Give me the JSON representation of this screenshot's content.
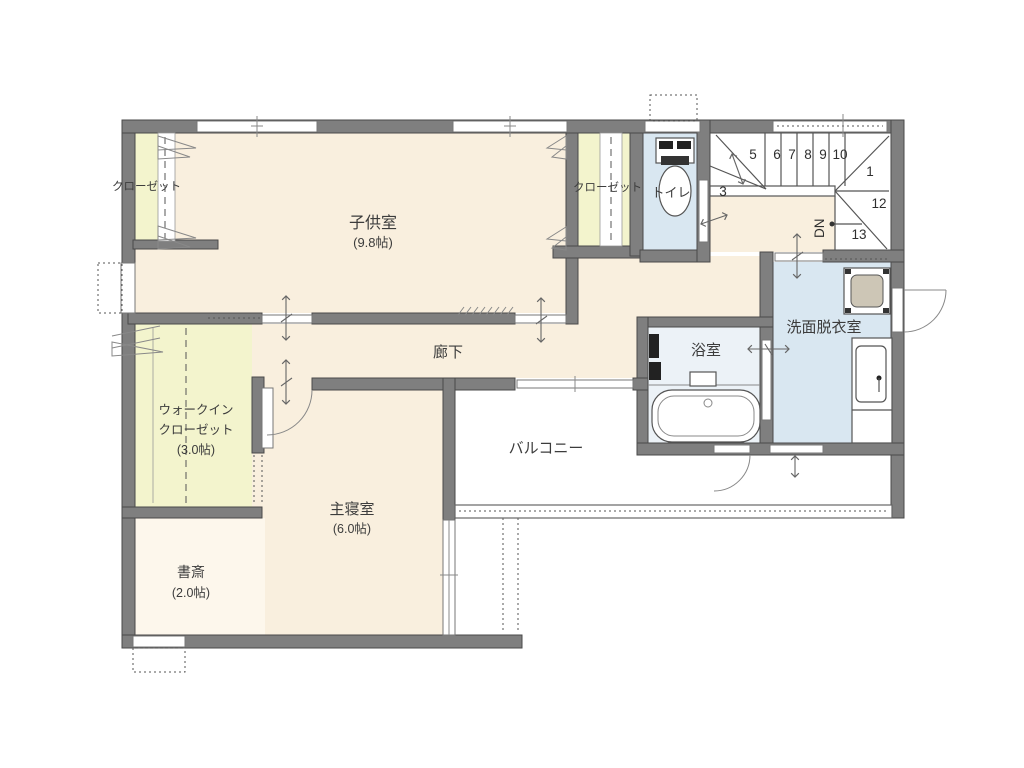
{
  "plan": {
    "rooms": {
      "children_room": {
        "name": "子供室",
        "size": "(9.8帖)"
      },
      "closet_left": {
        "name": "クローゼット"
      },
      "closet_middle": {
        "name": "クローゼット"
      },
      "toilet": {
        "name": "トイレ"
      },
      "hallway": {
        "name": "廊下"
      },
      "walk_in_closet": {
        "line1": "ウォークイン",
        "line2": "クローゼット",
        "size": "(3.0帖)"
      },
      "master_bedroom": {
        "name": "主寝室",
        "size": "(6.0帖)"
      },
      "study": {
        "name": "書斎",
        "size": "(2.0帖)"
      },
      "balcony": {
        "name": "バルコニー"
      },
      "bathroom": {
        "name": "浴室"
      },
      "washroom": {
        "name": "洗面脱衣室"
      }
    },
    "stairs": {
      "down_label": "DN",
      "steps": [
        "3",
        "5",
        "6",
        "7",
        "8",
        "9",
        "10",
        "1",
        "12",
        "13"
      ]
    },
    "colors": {
      "wall": "#7f7f7f",
      "room_cream": "#f9efde",
      "closet_yellow": "#f3f4cd",
      "wet_area_blue": "#d9e7f1",
      "bathroom_blue": "#ecf2f7",
      "line_gray": "#555555"
    }
  }
}
